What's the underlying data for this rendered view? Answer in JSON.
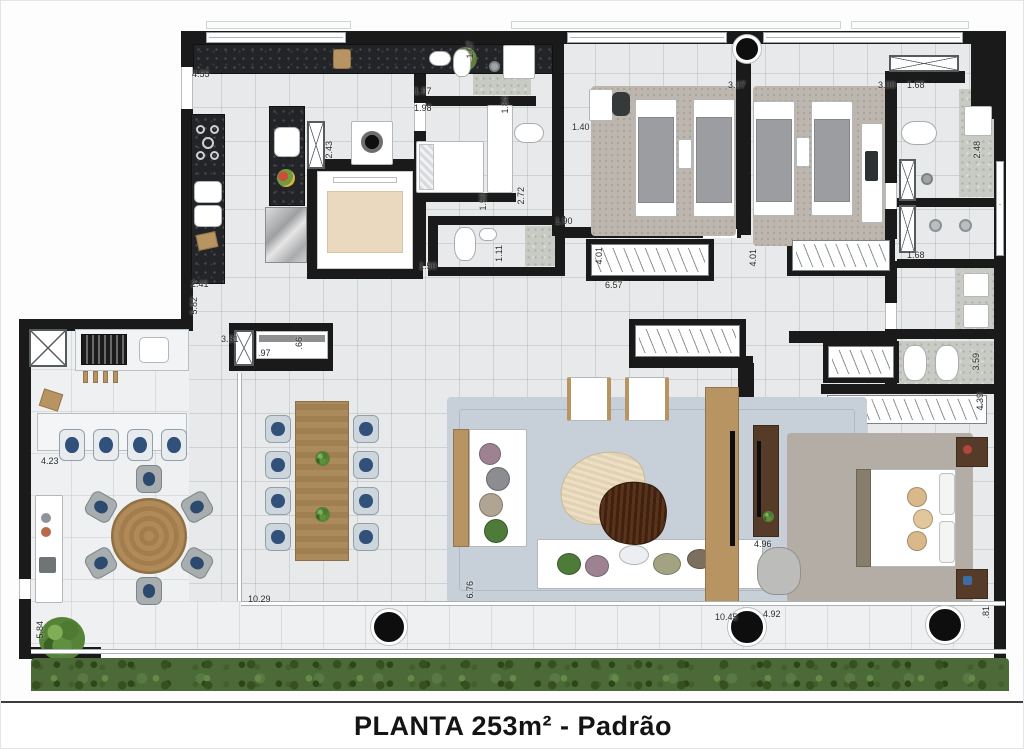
{
  "title": {
    "text": "PLANTA 253m² - Padrão"
  },
  "plan": {
    "type": "apartment-floor-plan",
    "dimension_unit": "m",
    "dimension_labels": [
      {
        "text": "4.55",
        "x": 191,
        "y": 69,
        "vertical": false
      },
      {
        "text": "1.97",
        "x": 413,
        "y": 86,
        "vertical": false
      },
      {
        "text": "1.98",
        "x": 413,
        "y": 103,
        "vertical": false
      },
      {
        "text": "1.07",
        "x": 465,
        "y": 40,
        "vertical": true
      },
      {
        "text": "1.84",
        "x": 500,
        "y": 95,
        "vertical": true
      },
      {
        "text": "1.40",
        "x": 571,
        "y": 122,
        "vertical": false
      },
      {
        "text": "3.07",
        "x": 727,
        "y": 80,
        "vertical": false
      },
      {
        "text": "3.00",
        "x": 877,
        "y": 80,
        "vertical": false
      },
      {
        "text": "1.68",
        "x": 906,
        "y": 80,
        "vertical": false
      },
      {
        "text": "2.48",
        "x": 972,
        "y": 140,
        "vertical": true
      },
      {
        "text": "2.43",
        "x": 324,
        "y": 140,
        "vertical": true
      },
      {
        "text": "2.72",
        "x": 516,
        "y": 186,
        "vertical": true
      },
      {
        "text": "1.90",
        "x": 554,
        "y": 216,
        "vertical": false
      },
      {
        "text": "1.50",
        "x": 478,
        "y": 192,
        "vertical": true
      },
      {
        "text": "1.11",
        "x": 494,
        "y": 244,
        "vertical": true
      },
      {
        "text": "1.50",
        "x": 418,
        "y": 261,
        "vertical": false
      },
      {
        "text": "6.57",
        "x": 604,
        "y": 280,
        "vertical": false
      },
      {
        "text": "4.01",
        "x": 594,
        "y": 246,
        "vertical": true
      },
      {
        "text": "4.01",
        "x": 748,
        "y": 248,
        "vertical": true
      },
      {
        "text": "1.68",
        "x": 906,
        "y": 250,
        "vertical": false
      },
      {
        "text": "2.41",
        "x": 190,
        "y": 279,
        "vertical": false
      },
      {
        "text": "5.82",
        "x": 189,
        "y": 296,
        "vertical": true
      },
      {
        "text": "3.31",
        "x": 220,
        "y": 334,
        "vertical": false
      },
      {
        "text": ".97",
        "x": 257,
        "y": 348,
        "vertical": false
      },
      {
        "text": ".66",
        "x": 294,
        "y": 336,
        "vertical": true
      },
      {
        "text": "4.23",
        "x": 40,
        "y": 456,
        "vertical": false
      },
      {
        "text": "5.84",
        "x": 35,
        "y": 620,
        "vertical": true
      },
      {
        "text": "10.29",
        "x": 247,
        "y": 594,
        "vertical": false
      },
      {
        "text": "6.76",
        "x": 465,
        "y": 580,
        "vertical": true
      },
      {
        "text": "10.45",
        "x": 714,
        "y": 612,
        "vertical": false
      },
      {
        "text": "4.92",
        "x": 762,
        "y": 609,
        "vertical": false
      },
      {
        "text": "4.96",
        "x": 753,
        "y": 539,
        "vertical": false
      },
      {
        "text": "3.59",
        "x": 971,
        "y": 352,
        "vertical": true
      },
      {
        "text": "4.39",
        "x": 975,
        "y": 392,
        "vertical": true
      },
      {
        "text": ".81",
        "x": 981,
        "y": 605,
        "vertical": true
      }
    ],
    "colors": {
      "wall": "#1a1a1a",
      "floor": "#e8e9ea",
      "granite_counter": "#232427",
      "hedge_green": "#4c6a37",
      "wood": "#b99463",
      "dark_wood": "#563c28",
      "living_rug": "#c7d0d8",
      "bedroom_rug": "#bcb6ae",
      "chair_seat_blue": "#31517a"
    }
  }
}
